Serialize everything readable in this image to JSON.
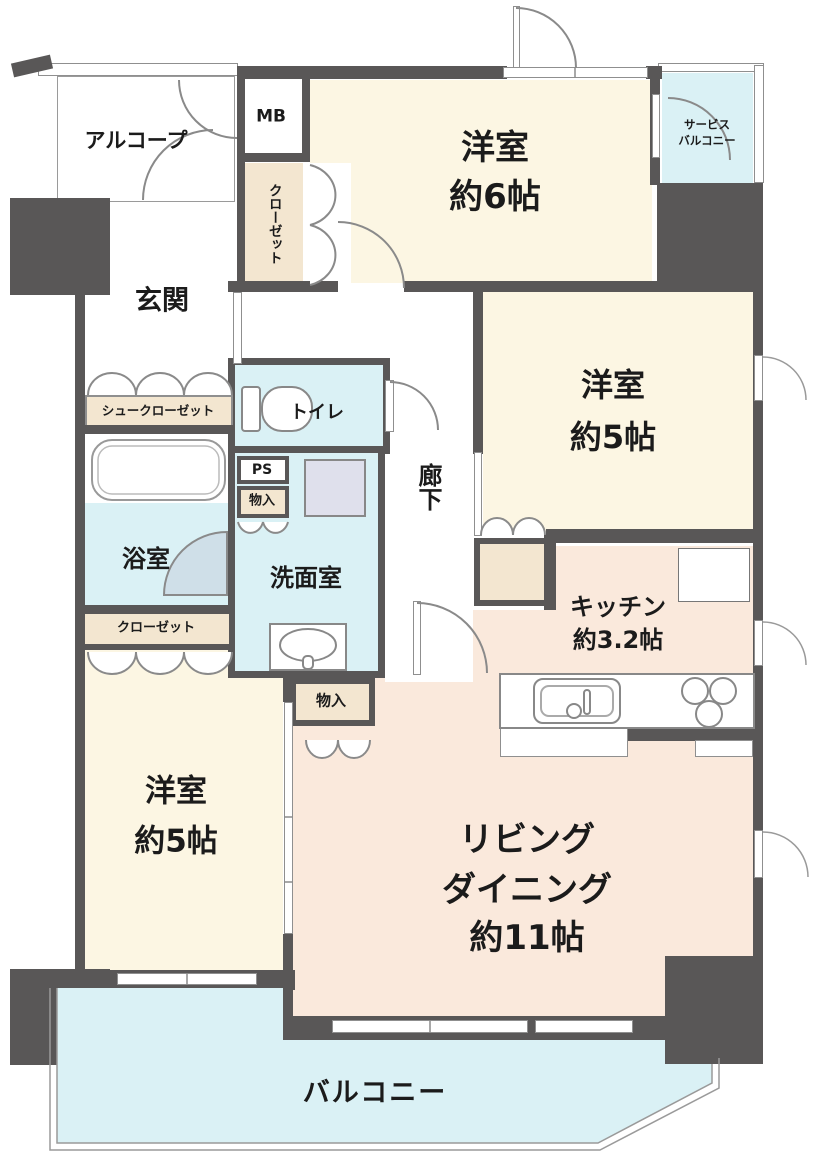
{
  "title": "apartment-floor-plan",
  "colors": {
    "wall": "#595757",
    "room_cream": "#fcf6e3",
    "room_peach": "#fae9dc",
    "water_blue": "#daf1f5",
    "closet_beige": "#f3e6d0",
    "fixture_lavender": "#dfe0ec",
    "outline_gray": "#8f8f8f"
  },
  "rooms": {
    "alcove": {
      "label": "アルコープ"
    },
    "mb": {
      "label": "MB"
    },
    "closet_north": {
      "label": "クローゼット"
    },
    "western6": {
      "label": "洋室",
      "size": "約6帖"
    },
    "service_balcony": {
      "label_line1": "サービス",
      "label_line2": "バルコニー"
    },
    "genkan": {
      "label": "玄関"
    },
    "shoe_closet": {
      "label": "シュークローゼット"
    },
    "toilet": {
      "label": "トイレ"
    },
    "ps": {
      "label": "PS"
    },
    "storage1": {
      "label": "物入"
    },
    "washroom": {
      "label": "洗面室"
    },
    "bathroom": {
      "label": "浴室"
    },
    "closet_west": {
      "label": "クローゼット"
    },
    "hallway": {
      "label": "廊下"
    },
    "western5_west": {
      "label": "洋室",
      "size": "約5帖"
    },
    "western5_east": {
      "label": "洋室",
      "size": "約5帖"
    },
    "kitchen": {
      "label": "キッチン",
      "size": "約3.2帖"
    },
    "storage2": {
      "label": "物入"
    },
    "living_dining": {
      "label_line1": "リビング",
      "label_line2": "ダイニング",
      "size": "約11帖"
    },
    "balcony": {
      "label": "バルコニー"
    }
  },
  "fixtures": [
    "bathtub-icon",
    "toilet-icon",
    "washbasin-icon",
    "washing-machine-space",
    "kitchen-sink-icon",
    "stove-burners-icon",
    "door-swing-arc",
    "folding-door-arc",
    "window-band"
  ]
}
